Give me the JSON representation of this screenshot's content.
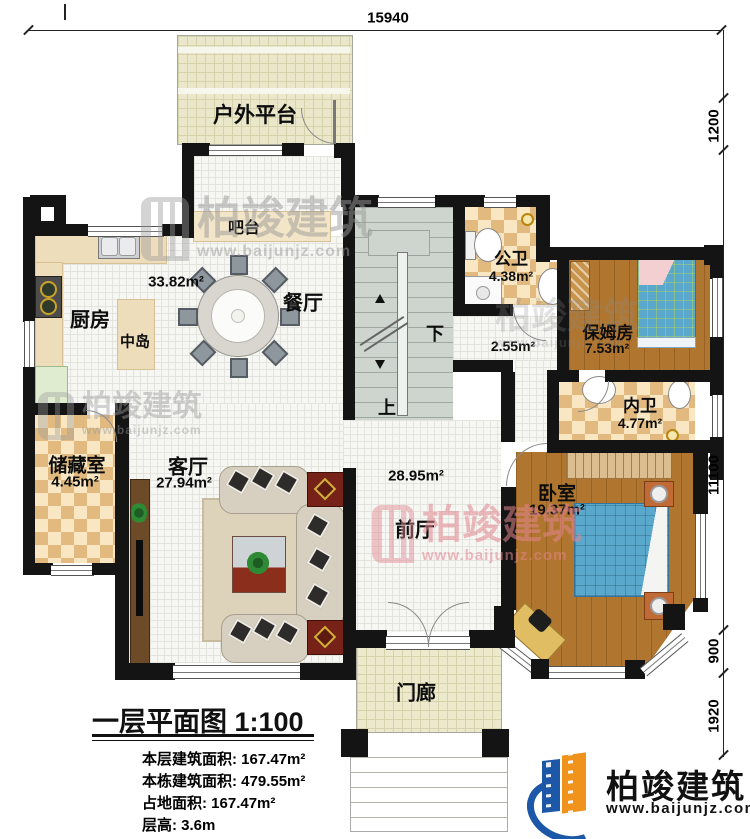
{
  "plan": {
    "title": "一层平面图",
    "scale": "1:100",
    "stats": [
      {
        "label": "本层建筑面积:",
        "value": "167.47m²"
      },
      {
        "label": "本栋建筑面积:",
        "value": "479.55m²"
      },
      {
        "label": "占地面积:",
        "value": "167.47m²"
      },
      {
        "label": "层高:",
        "value": "3.6m"
      }
    ]
  },
  "dimensions": {
    "top": "15940",
    "right_top": "1200",
    "right_main": "11100",
    "right_lower": "900",
    "right_bottom": "1920"
  },
  "rooms": {
    "outdoor": {
      "name": "户外平台"
    },
    "bar": {
      "name": "吧台"
    },
    "kitchen": {
      "name": "厨房"
    },
    "island": {
      "name": "中岛"
    },
    "dining": {
      "name": "餐厅"
    },
    "open_area": {
      "area": "33.82m²"
    },
    "public_bath": {
      "name": "公卫",
      "area": "4.38m²"
    },
    "hall_small": {
      "area": "2.55m²"
    },
    "nanny": {
      "name": "保姆房",
      "area": "7.53m²"
    },
    "inner_bath": {
      "name": "内卫",
      "area": "4.77m²"
    },
    "storage": {
      "name": "储藏室",
      "area": "4.45m²"
    },
    "living": {
      "name": "客厅",
      "area": "27.94m²"
    },
    "foyer": {
      "name": "前厅",
      "area": "28.95m²"
    },
    "bedroom": {
      "name": "卧室",
      "area": "19.37m²"
    },
    "porch": {
      "name": "门廊"
    }
  },
  "stairs": {
    "down": "下",
    "up": "上"
  },
  "watermark": {
    "brand": "柏竣建筑",
    "url": "www.baijunjz.com"
  },
  "logo": {
    "brand": "柏竣建筑",
    "url": "www.baijunjz.com"
  },
  "colors": {
    "wall": "#141414",
    "wood": "#b0762f",
    "bed": "#5aa8cc",
    "accent_blue": "#1d57a7",
    "accent_orange": "#f0931d"
  }
}
